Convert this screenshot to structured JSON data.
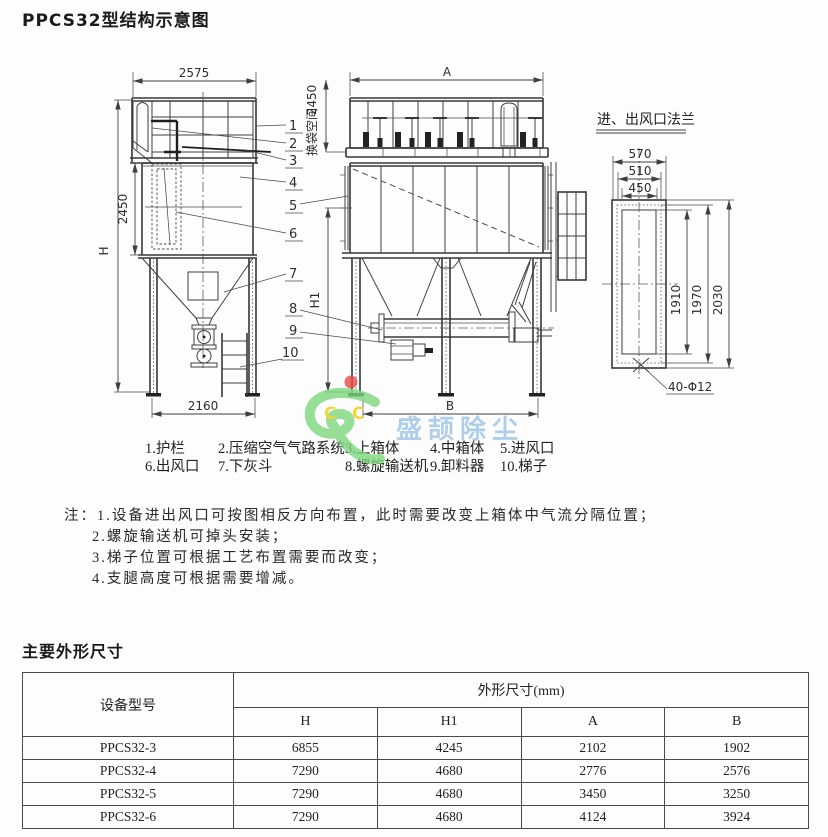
{
  "page": {
    "title": "PPCS32型结构示意图"
  },
  "drawing": {
    "dims": {
      "left_width": "2575",
      "left_height": "H",
      "left_mid_height": "2450",
      "bag_space_label": "换袋空间",
      "bag_space_value": "2450",
      "left_base": "2160",
      "front_width": "A",
      "front_mid_height": "H1",
      "front_base": "B"
    },
    "part_numbers": [
      "1",
      "2",
      "3",
      "4",
      "5",
      "6",
      "7",
      "8",
      "9",
      "10"
    ],
    "flange": {
      "title": "进、出风口法兰",
      "width_outer": "570",
      "width_bolt": "510",
      "width_inner": "450",
      "height_inner": "1910",
      "height_bolt": "1970",
      "height_outer": "2030",
      "holes": "40-Φ12"
    },
    "legend": [
      "1.护栏",
      "2.压缩空气气路系统",
      "3.上箱体",
      "4.中箱体",
      "5.进风口",
      "6.出风口",
      "7.下灰斗",
      "8.螺旋输送机",
      "9.卸料器",
      "10.梯子"
    ]
  },
  "watermark": {
    "text": "盛颉除尘",
    "c_left": "C",
    "c_right": "C",
    "text_color": "#9cc3e6",
    "logo_green": "#7ed87e",
    "logo_yellow": "#f2cc0c",
    "dot_red": "#ea4848"
  },
  "notes": {
    "prefix": "注：",
    "lines": [
      "1.设备进出风口可按图相反方向布置，此时需要改变上箱体中气流分隔位置；",
      "2.螺旋输送机可掉头安装；",
      "3.梯子位置可根据工艺布置需要而改变；",
      "4.支腿高度可根据需要增减。"
    ]
  },
  "dimensions_section": {
    "heading": "主要外形尺寸",
    "table": {
      "col_model": "设备型号",
      "col_group": "外形尺寸(mm)",
      "sub_cols": [
        "H",
        "H1",
        "A",
        "B"
      ],
      "rows": [
        {
          "model": "PPCS32-3",
          "H": "6855",
          "H1": "4245",
          "A": "2102",
          "B": "1902"
        },
        {
          "model": "PPCS32-4",
          "H": "7290",
          "H1": "4680",
          "A": "2776",
          "B": "2576"
        },
        {
          "model": "PPCS32-5",
          "H": "7290",
          "H1": "4680",
          "A": "3450",
          "B": "3250"
        },
        {
          "model": "PPCS32-6",
          "H": "7290",
          "H1": "4680",
          "A": "4124",
          "B": "3924"
        }
      ]
    }
  }
}
